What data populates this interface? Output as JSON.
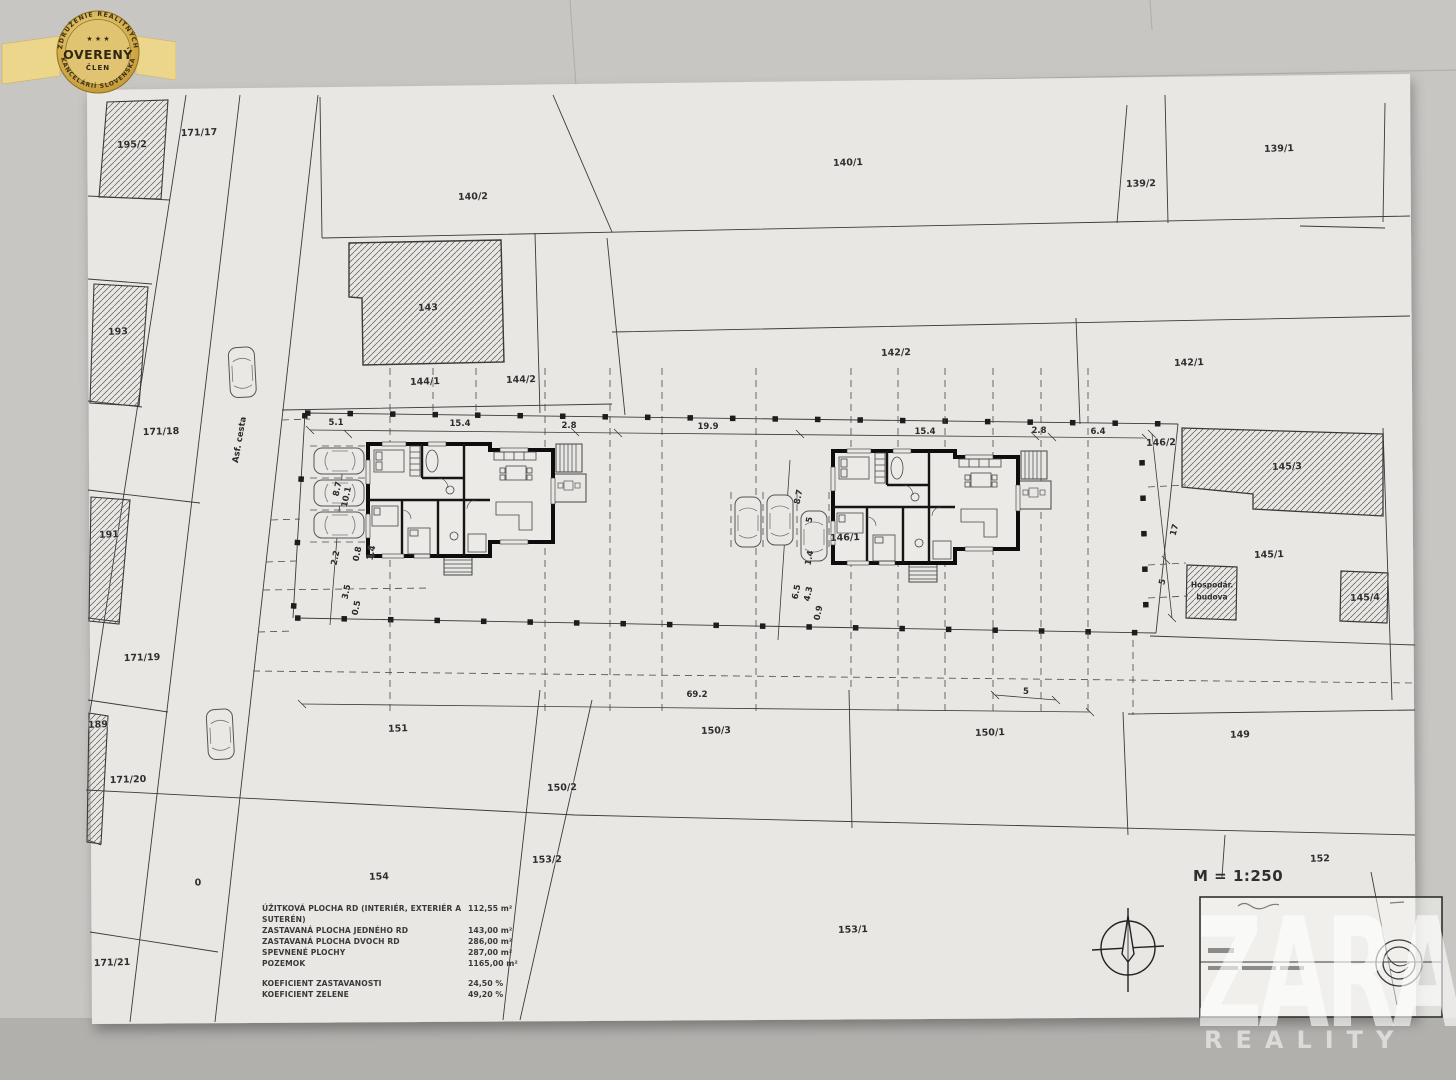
{
  "badge": {
    "arc_top": "ZDRUŽENIE REALITNÝCH",
    "stars": "★ ★ ★",
    "title": "OVERENÝ",
    "subtitle": "ČLEN",
    "arc_bottom": "KANCELÁRIÍ SLOVENSKA",
    "gold": "#c9a43c"
  },
  "watermark": {
    "brand": "ZARA",
    "sub": "REALITY"
  },
  "titleblock": {
    "scale_label": "M = 1:250"
  },
  "legend": {
    "rows": [
      {
        "label": "ÚŽITKOVÁ PLOCHA RD (INTERIÉR, EXTERIÉR A SUTERÉN)",
        "value": "112,55 m²"
      },
      {
        "label": "ZASTAVANÁ PLOCHA JEDNÉHO RD",
        "value": "143,00 m²"
      },
      {
        "label": "ZASTAVANÁ PLOCHA DVOCH RD",
        "value": "286,00 m²"
      },
      {
        "label": "SPEVNENÉ PLOCHY",
        "value": "287,00 m²"
      },
      {
        "label": "POZEMOK",
        "value": "1165,00 m²"
      },
      {
        "label": "KOEFICIENT ZASTAVANOSTI",
        "value": "24,50 %"
      },
      {
        "label": "KOEFICIENT ZELENE",
        "value": "49,20 %"
      }
    ]
  },
  "plan": {
    "road_label": "Asf. cesta",
    "outbuilding_label_line1": "Hospodár.",
    "outbuilding_label_line2": "budova",
    "parcels": [
      {
        "text": "195/2",
        "x": 132,
        "y": 145
      },
      {
        "text": "171/17",
        "x": 199,
        "y": 133
      },
      {
        "text": "193",
        "x": 118,
        "y": 332
      },
      {
        "text": "171/18",
        "x": 161,
        "y": 432
      },
      {
        "text": "191",
        "x": 109,
        "y": 535
      },
      {
        "text": "171/19",
        "x": 142,
        "y": 658
      },
      {
        "text": "189",
        "x": 98,
        "y": 725
      },
      {
        "text": "171/20",
        "x": 128,
        "y": 780
      },
      {
        "text": "0",
        "x": 198,
        "y": 883
      },
      {
        "text": "171/21",
        "x": 112,
        "y": 963
      },
      {
        "text": "140/2",
        "x": 473,
        "y": 197
      },
      {
        "text": "140/1",
        "x": 848,
        "y": 163
      },
      {
        "text": "139/2",
        "x": 1141,
        "y": 184
      },
      {
        "text": "139/1",
        "x": 1279,
        "y": 149
      },
      {
        "text": "143",
        "x": 428,
        "y": 308
      },
      {
        "text": "144/1",
        "x": 425,
        "y": 382
      },
      {
        "text": "144/2",
        "x": 521,
        "y": 380
      },
      {
        "text": "142/2",
        "x": 896,
        "y": 353
      },
      {
        "text": "142/1",
        "x": 1189,
        "y": 363
      },
      {
        "text": "146/2",
        "x": 1161,
        "y": 443
      },
      {
        "text": "145/3",
        "x": 1287,
        "y": 467
      },
      {
        "text": "145/1",
        "x": 1269,
        "y": 555
      },
      {
        "text": "145/4",
        "x": 1365,
        "y": 598
      },
      {
        "text": "146/1",
        "x": 845,
        "y": 538
      },
      {
        "text": "151",
        "x": 398,
        "y": 729
      },
      {
        "text": "150/3",
        "x": 716,
        "y": 731
      },
      {
        "text": "150/1",
        "x": 990,
        "y": 733
      },
      {
        "text": "149",
        "x": 1240,
        "y": 735
      },
      {
        "text": "150/2",
        "x": 562,
        "y": 788
      },
      {
        "text": "153/2",
        "x": 547,
        "y": 860
      },
      {
        "text": "152",
        "x": 1320,
        "y": 859
      },
      {
        "text": "154",
        "x": 379,
        "y": 877
      },
      {
        "text": "153/1",
        "x": 853,
        "y": 930
      }
    ],
    "dimensions": [
      {
        "text": "5.1",
        "x": 336,
        "y": 423,
        "rot": 0
      },
      {
        "text": "15.4",
        "x": 460,
        "y": 424,
        "rot": 0
      },
      {
        "text": "2.8",
        "x": 569,
        "y": 426,
        "rot": 0
      },
      {
        "text": "19.9",
        "x": 708,
        "y": 427,
        "rot": 0
      },
      {
        "text": "15.4",
        "x": 925,
        "y": 432,
        "rot": 0
      },
      {
        "text": "2.8",
        "x": 1039,
        "y": 431,
        "rot": 0
      },
      {
        "text": "6.4",
        "x": 1098,
        "y": 432,
        "rot": 0
      },
      {
        "text": "69.2",
        "x": 697,
        "y": 695,
        "rot": 0
      },
      {
        "text": "5",
        "x": 1026,
        "y": 692,
        "rot": 0
      },
      {
        "text": "8.7",
        "x": 338,
        "y": 489,
        "rot": -78
      },
      {
        "text": "10.1",
        "x": 347,
        "y": 497,
        "rot": -78
      },
      {
        "text": "2.2",
        "x": 336,
        "y": 558,
        "rot": -78
      },
      {
        "text": "0.8",
        "x": 358,
        "y": 554,
        "rot": -78
      },
      {
        "text": "1.4",
        "x": 372,
        "y": 553,
        "rot": -78
      },
      {
        "text": "3.5",
        "x": 347,
        "y": 592,
        "rot": -78
      },
      {
        "text": "0.5",
        "x": 357,
        "y": 608,
        "rot": -78
      },
      {
        "text": "8.7",
        "x": 799,
        "y": 497,
        "rot": -78
      },
      {
        "text": "5",
        "x": 810,
        "y": 520,
        "rot": -78
      },
      {
        "text": "1.4",
        "x": 810,
        "y": 558,
        "rot": -78
      },
      {
        "text": "6.5",
        "x": 797,
        "y": 592,
        "rot": -78
      },
      {
        "text": "4.3",
        "x": 809,
        "y": 594,
        "rot": -78
      },
      {
        "text": "0.9",
        "x": 819,
        "y": 613,
        "rot": -78
      },
      {
        "text": "17",
        "x": 1175,
        "y": 530,
        "rot": -75
      },
      {
        "text": "5",
        "x": 1163,
        "y": 582,
        "rot": -75
      }
    ]
  }
}
